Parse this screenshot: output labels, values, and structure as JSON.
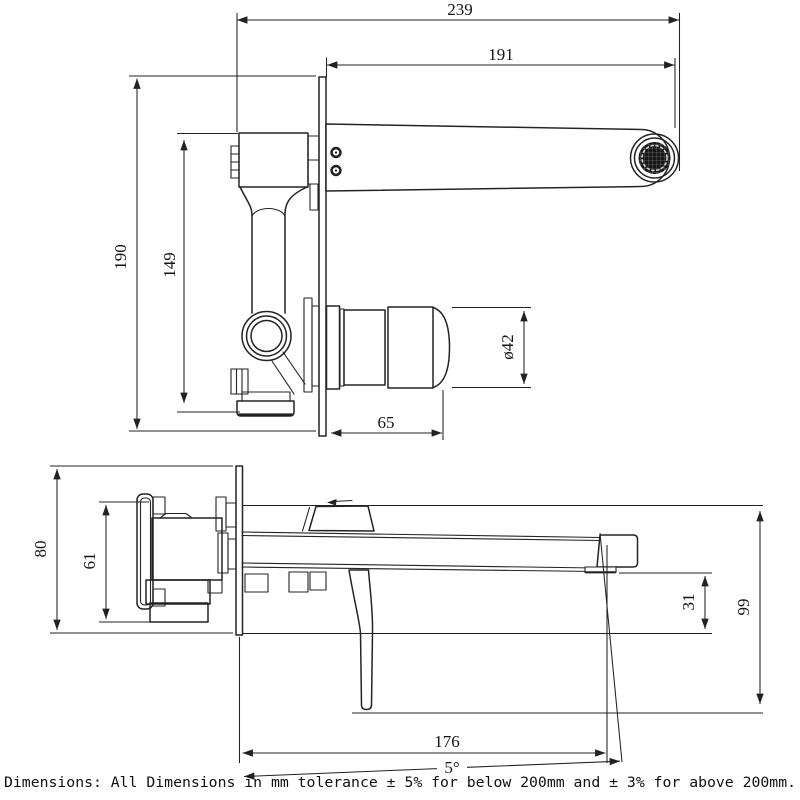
{
  "drawing": {
    "note": "Dimensions: All Dimensions in mm tolerance ± 5% for below 200mm and ± 3% for above 200mm.",
    "views": {
      "top": {
        "dims": {
          "overall_length": "239",
          "spout_reach": "191",
          "plate_height": "190",
          "body_height": "149",
          "handle_diameter": "ø42",
          "handle_length": "65"
        }
      },
      "side": {
        "dims": {
          "plate_width": "80",
          "body_width": "61",
          "spout_drop": "31",
          "total_drop": "99",
          "tip_reach": "176",
          "spout_angle": "5°"
        }
      }
    }
  }
}
